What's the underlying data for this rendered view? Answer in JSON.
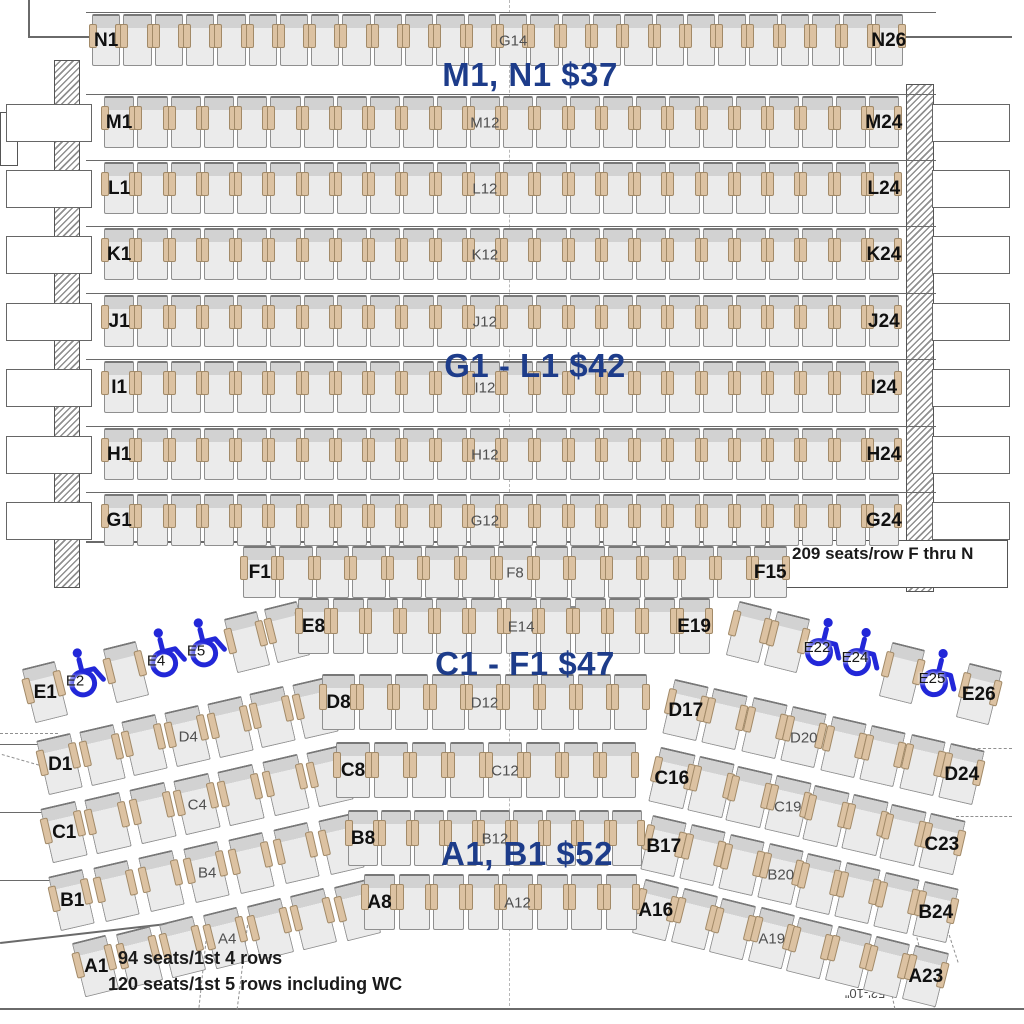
{
  "canvas": {
    "width": 1024,
    "height": 1024
  },
  "colors": {
    "price_label": "#1d3c8a",
    "wheelchair": "#2227d8",
    "seat_body": "#ebebeb",
    "seat_back": "#d2d2d2",
    "armrest": "#dcc2a2"
  },
  "price_labels": [
    {
      "id": "price-mn",
      "text": "M1, N1 $37"
    },
    {
      "id": "price-gl",
      "text": "G1 - L1 $42"
    },
    {
      "id": "price-cf",
      "text": "C1 - F1 $47"
    },
    {
      "id": "price-ab",
      "text": "A1, B1 $52"
    }
  ],
  "notes": {
    "row_f_thru_n": "209 seats/row F thru N",
    "first_four_rows": "94 seats/1st 4 rows",
    "first_five_rows": "120 seats/1st 5 rows including WC",
    "stage_width_dimension": "52'-10\""
  },
  "straight_rows": [
    {
      "name": "N",
      "seat_count": 26,
      "labels": [
        {
          "seat": 1,
          "text": "N1",
          "style": "edge"
        },
        {
          "seat": 14,
          "text": "G14",
          "style": "mid"
        },
        {
          "seat": 26,
          "text": "N26",
          "style": "edge"
        }
      ]
    },
    {
      "name": "M",
      "seat_count": 24,
      "labels": [
        {
          "seat": 1,
          "text": "M1",
          "style": "edge"
        },
        {
          "seat": 12,
          "text": "M12",
          "style": "mid"
        },
        {
          "seat": 24,
          "text": "M24",
          "style": "edge"
        }
      ]
    },
    {
      "name": "L",
      "seat_count": 24,
      "labels": [
        {
          "seat": 1,
          "text": "L1",
          "style": "edge"
        },
        {
          "seat": 12,
          "text": "L12",
          "style": "mid"
        },
        {
          "seat": 24,
          "text": "L24",
          "style": "edge"
        }
      ]
    },
    {
      "name": "K",
      "seat_count": 24,
      "labels": [
        {
          "seat": 1,
          "text": "K1",
          "style": "edge"
        },
        {
          "seat": 12,
          "text": "K12",
          "style": "mid"
        },
        {
          "seat": 24,
          "text": "K24",
          "style": "edge"
        }
      ]
    },
    {
      "name": "J",
      "seat_count": 24,
      "labels": [
        {
          "seat": 1,
          "text": "J1",
          "style": "edge"
        },
        {
          "seat": 12,
          "text": "J12",
          "style": "mid"
        },
        {
          "seat": 24,
          "text": "J24",
          "style": "edge"
        }
      ]
    },
    {
      "name": "I",
      "seat_count": 24,
      "labels": [
        {
          "seat": 1,
          "text": "I1",
          "style": "edge"
        },
        {
          "seat": 12,
          "text": "I12",
          "style": "mid"
        },
        {
          "seat": 24,
          "text": "I24",
          "style": "edge"
        }
      ]
    },
    {
      "name": "H",
      "seat_count": 24,
      "labels": [
        {
          "seat": 1,
          "text": "H1",
          "style": "edge"
        },
        {
          "seat": 12,
          "text": "H12",
          "style": "mid"
        },
        {
          "seat": 24,
          "text": "H24",
          "style": "edge"
        }
      ]
    },
    {
      "name": "G",
      "seat_count": 24,
      "labels": [
        {
          "seat": 1,
          "text": "G1",
          "style": "edge"
        },
        {
          "seat": 12,
          "text": "G12",
          "style": "mid"
        },
        {
          "seat": 24,
          "text": "G24",
          "style": "edge"
        }
      ]
    },
    {
      "name": "F",
      "seat_count": 15,
      "labels": [
        {
          "seat": 1,
          "text": "F1",
          "style": "edge"
        },
        {
          "seat": 8,
          "text": "F8",
          "style": "mid"
        },
        {
          "seat": 15,
          "text": "F15",
          "style": "edge"
        }
      ]
    }
  ],
  "curved_rows": [
    {
      "name": "E",
      "left": [
        {
          "type": "seat",
          "label": "E1",
          "style": "edge"
        },
        {
          "type": "wc",
          "label": "E2"
        },
        {
          "type": "seat"
        },
        {
          "type": "wc",
          "label": "E4"
        },
        {
          "type": "wc",
          "label": "E5"
        },
        {
          "type": "seat"
        },
        {
          "type": "seat"
        }
      ],
      "center": {
        "seat_count": 12,
        "labels": [
          {
            "seat": 1,
            "text": "E8",
            "style": "edge"
          },
          {
            "seat": 7,
            "text": "E14",
            "style": "mid"
          },
          {
            "seat": 12,
            "text": "E19",
            "style": "edge"
          }
        ]
      },
      "right": [
        {
          "type": "seat"
        },
        {
          "type": "seat"
        },
        {
          "type": "wc",
          "label": "E22"
        },
        {
          "type": "wc",
          "label": "E24"
        },
        {
          "type": "seat"
        },
        {
          "type": "wc",
          "label": "E25"
        },
        {
          "type": "seat",
          "label": "E26",
          "style": "edge"
        }
      ]
    },
    {
      "name": "D",
      "left": [
        {
          "type": "seat",
          "label": "D1",
          "style": "edge"
        },
        {
          "type": "seat"
        },
        {
          "type": "seat"
        },
        {
          "type": "seat",
          "label": "D4",
          "style": "mid"
        },
        {
          "type": "seat"
        },
        {
          "type": "seat"
        },
        {
          "type": "seat"
        }
      ],
      "center": {
        "seat_count": 9,
        "labels": [
          {
            "seat": 1,
            "text": "D8",
            "style": "edge"
          },
          {
            "seat": 5,
            "text": "D12",
            "style": "mid"
          }
        ]
      },
      "right": [
        {
          "type": "seat",
          "label": "D17",
          "style": "edge"
        },
        {
          "type": "seat"
        },
        {
          "type": "seat"
        },
        {
          "type": "seat",
          "label": "D20",
          "style": "mid"
        },
        {
          "type": "seat"
        },
        {
          "type": "seat"
        },
        {
          "type": "seat"
        },
        {
          "type": "seat",
          "label": "D24",
          "style": "edge"
        }
      ]
    },
    {
      "name": "C",
      "left": [
        {
          "type": "seat",
          "label": "C1",
          "style": "edge"
        },
        {
          "type": "seat"
        },
        {
          "type": "seat"
        },
        {
          "type": "seat",
          "label": "C4",
          "style": "mid"
        },
        {
          "type": "seat"
        },
        {
          "type": "seat"
        },
        {
          "type": "seat"
        }
      ],
      "center": {
        "seat_count": 8,
        "labels": [
          {
            "seat": 1,
            "text": "C8",
            "style": "edge"
          },
          {
            "seat": 5,
            "text": "C12",
            "style": "mid"
          }
        ]
      },
      "right": [
        {
          "type": "seat",
          "label": "C16",
          "style": "edge"
        },
        {
          "type": "seat"
        },
        {
          "type": "seat"
        },
        {
          "type": "seat",
          "label": "C19",
          "style": "mid"
        },
        {
          "type": "seat"
        },
        {
          "type": "seat"
        },
        {
          "type": "seat"
        },
        {
          "type": "seat",
          "label": "C23",
          "style": "edge"
        }
      ]
    },
    {
      "name": "B",
      "left": [
        {
          "type": "seat",
          "label": "B1",
          "style": "edge"
        },
        {
          "type": "seat"
        },
        {
          "type": "seat"
        },
        {
          "type": "seat",
          "label": "B4",
          "style": "mid"
        },
        {
          "type": "seat"
        },
        {
          "type": "seat"
        },
        {
          "type": "seat"
        }
      ],
      "center": {
        "seat_count": 9,
        "labels": [
          {
            "seat": 1,
            "text": "B8",
            "style": "edge"
          },
          {
            "seat": 5,
            "text": "B12",
            "style": "mid"
          }
        ]
      },
      "right": [
        {
          "type": "seat",
          "label": "B17",
          "style": "edge"
        },
        {
          "type": "seat"
        },
        {
          "type": "seat"
        },
        {
          "type": "seat",
          "label": "B20",
          "style": "mid"
        },
        {
          "type": "seat"
        },
        {
          "type": "seat"
        },
        {
          "type": "seat"
        },
        {
          "type": "seat",
          "label": "B24",
          "style": "edge"
        }
      ]
    },
    {
      "name": "A",
      "left": [
        {
          "type": "seat",
          "label": "A1",
          "style": "edge"
        },
        {
          "type": "seat"
        },
        {
          "type": "seat"
        },
        {
          "type": "seat",
          "label": "A4",
          "style": "mid"
        },
        {
          "type": "seat"
        },
        {
          "type": "seat"
        },
        {
          "type": "seat"
        }
      ],
      "center": {
        "seat_count": 8,
        "labels": [
          {
            "seat": 1,
            "text": "A8",
            "style": "edge"
          },
          {
            "seat": 5,
            "text": "A12",
            "style": "mid"
          }
        ]
      },
      "right": [
        {
          "type": "seat",
          "label": "A16",
          "style": "edge"
        },
        {
          "type": "seat"
        },
        {
          "type": "seat"
        },
        {
          "type": "seat",
          "label": "A19",
          "style": "mid"
        },
        {
          "type": "seat"
        },
        {
          "type": "seat"
        },
        {
          "type": "seat"
        },
        {
          "type": "seat",
          "label": "A23",
          "style": "edge"
        }
      ]
    }
  ]
}
